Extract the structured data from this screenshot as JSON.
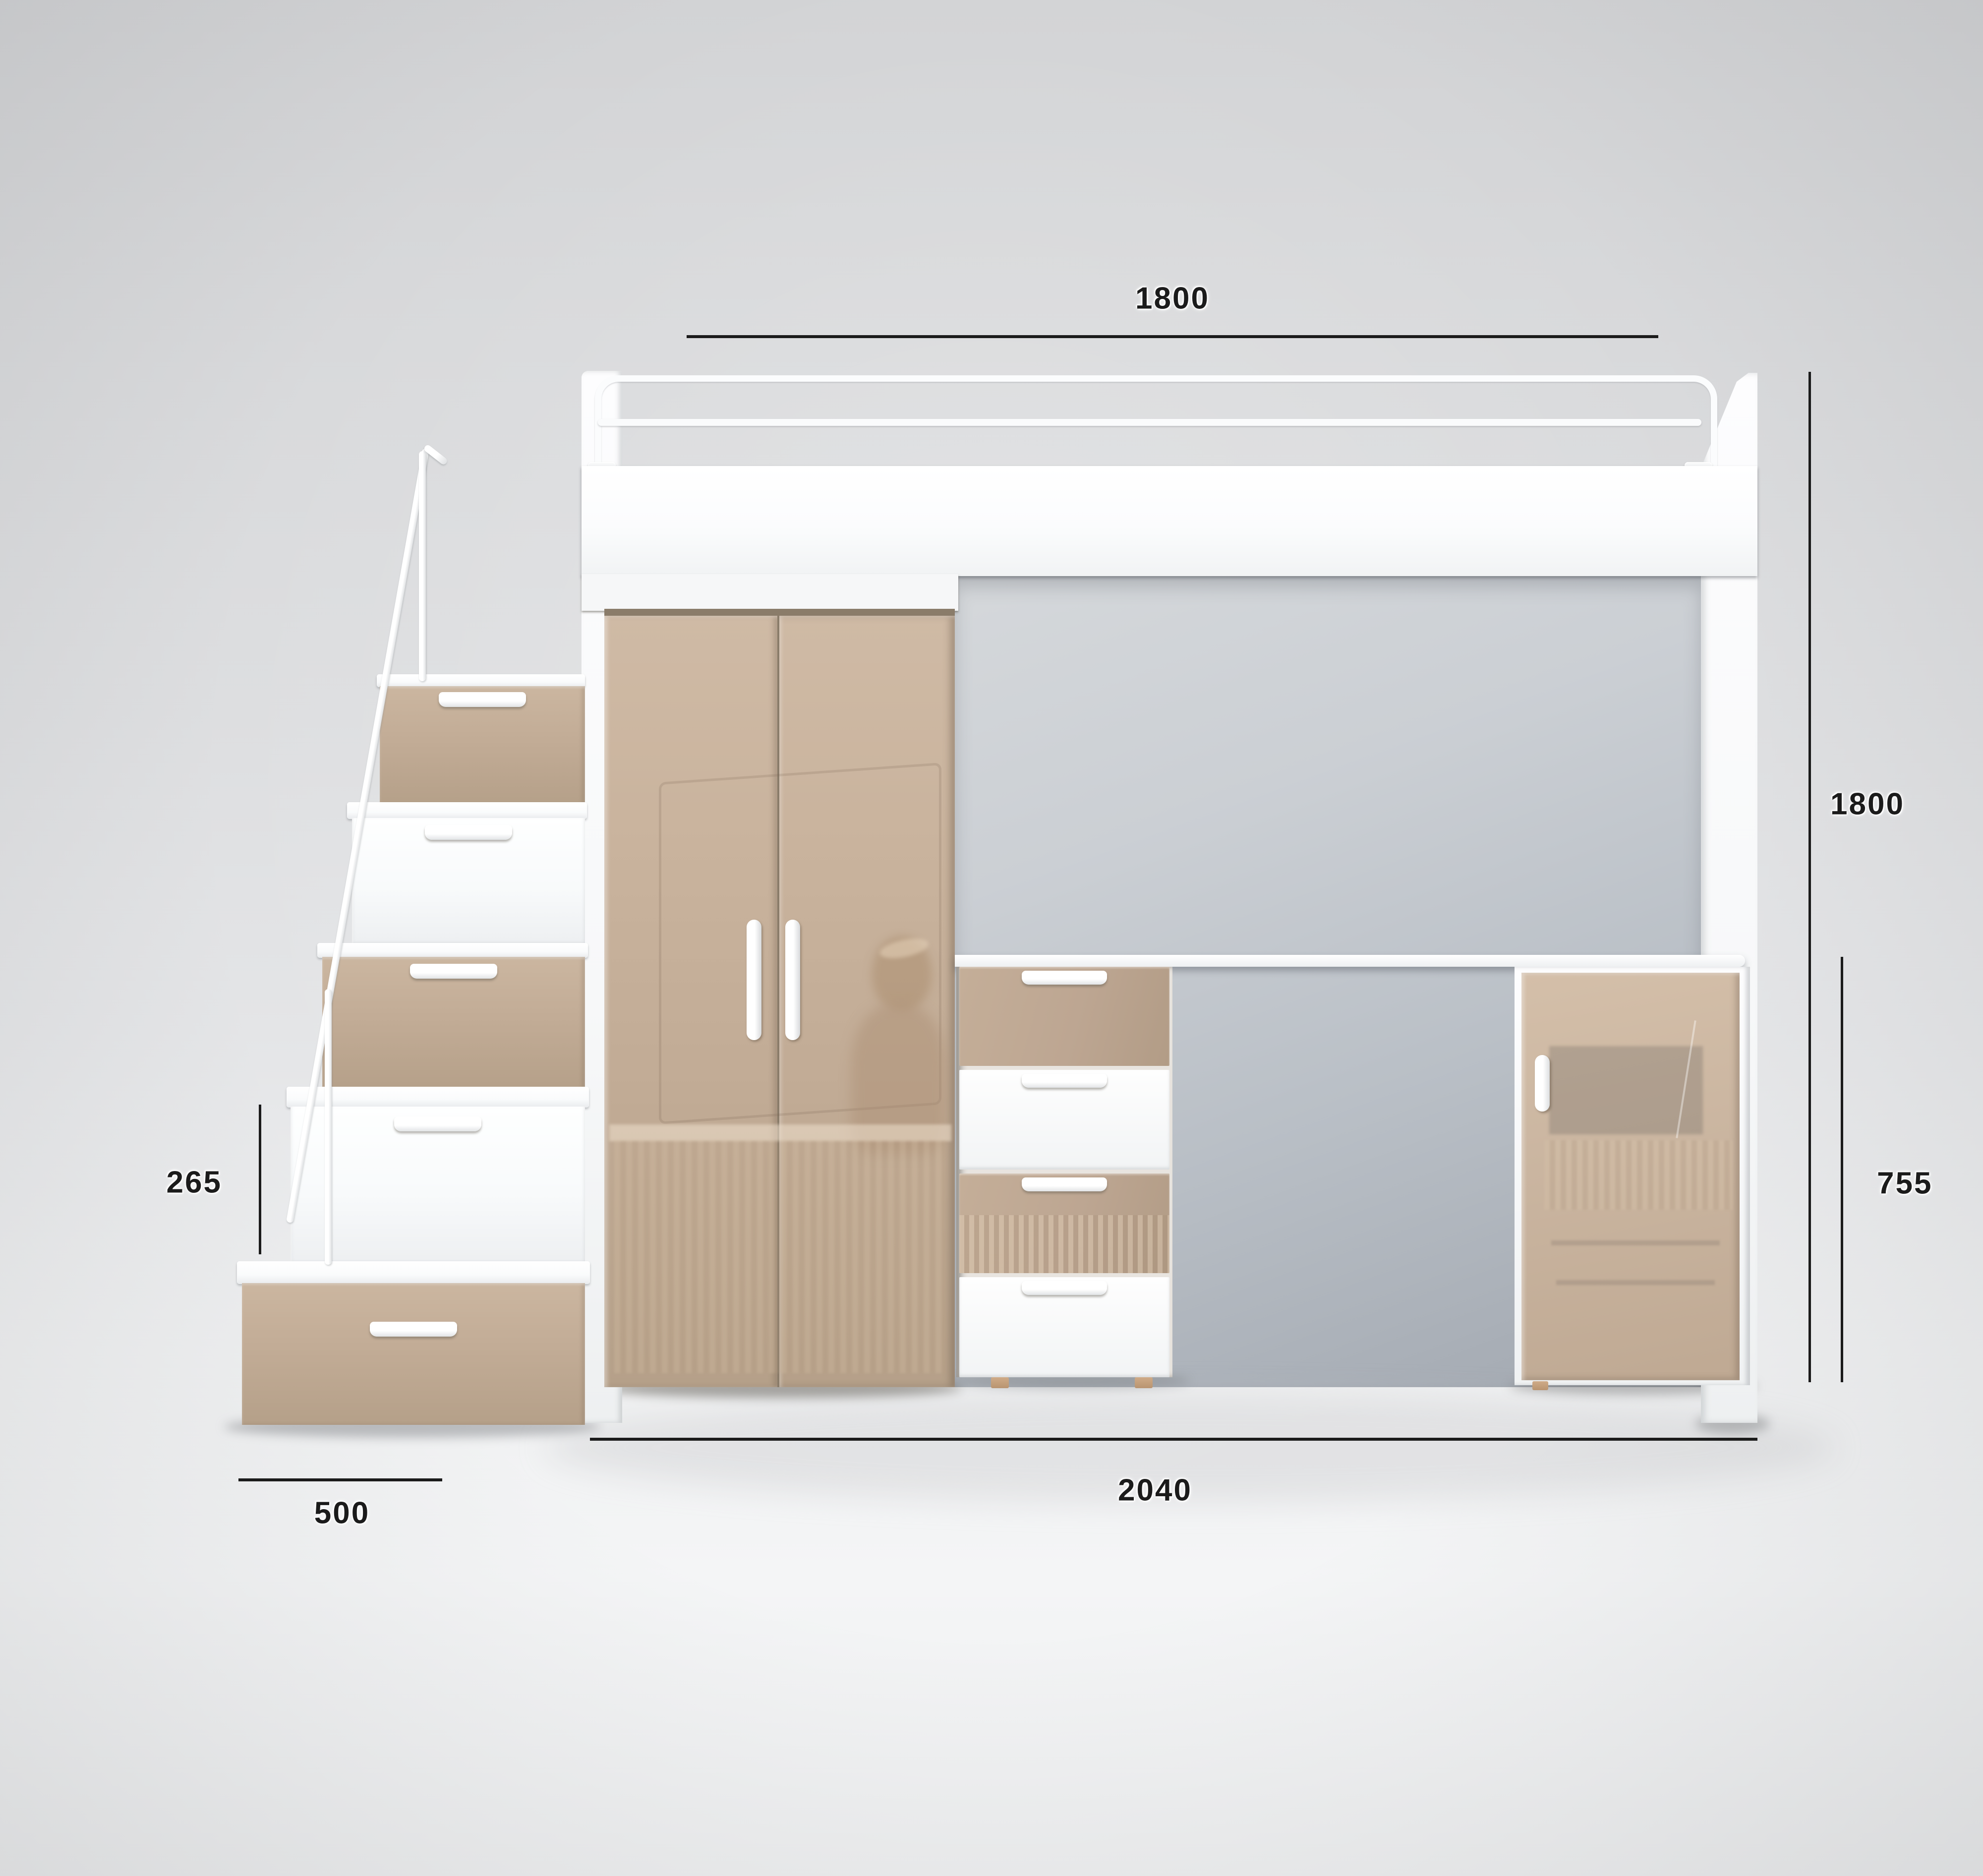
{
  "scene": {
    "subject": "loft bed unit with wardrobe, desk, side cabinet and storage stairs",
    "style": "product dimension render",
    "colors": {
      "beige_gloss": "#c2ac96",
      "furniture_white": "#fbfcfd",
      "back_wall_gray": "#b9bfc6",
      "background_gray": "#dddee0",
      "floor_white": "#f4f5f6",
      "dimension_line": "#1b1b1b"
    },
    "dimensions": {
      "bed_top_length": {
        "value": "1800"
      },
      "overall_height": {
        "value": "1800"
      },
      "desk_height": {
        "value": "755"
      },
      "step_height": {
        "value": "265"
      },
      "stairs_depth": {
        "value": "500"
      },
      "unit_width": {
        "value": "2040"
      }
    }
  }
}
